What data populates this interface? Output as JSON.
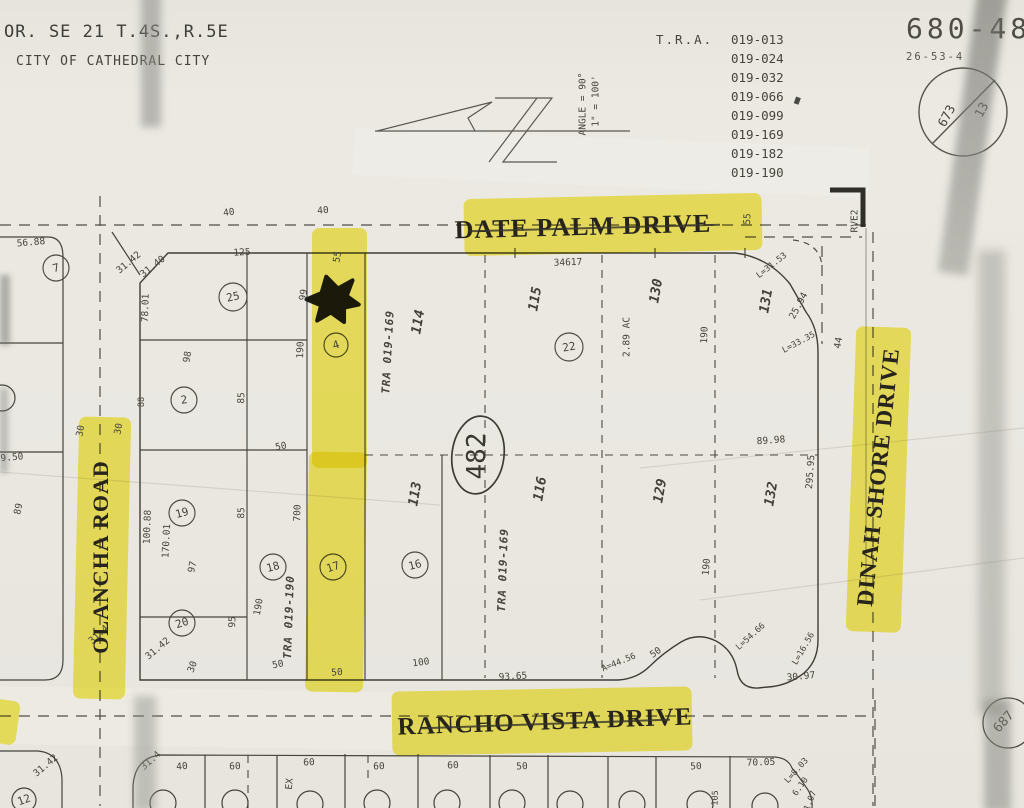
{
  "title_block": {
    "line1": "OR. SE 21 T.4S.,R.5E",
    "line2": "CITY OF CATHEDRAL CITY"
  },
  "tra_block": {
    "label": "T.R.A.",
    "codes": [
      "019-013",
      "019-024",
      "019-032",
      "019-066",
      "019-099",
      "019-169",
      "019-182",
      "019-190"
    ]
  },
  "sheet_block": {
    "number": "680-48",
    "code": "26-53-4",
    "circle_left": "673",
    "circle_right": "13",
    "adjacent_sheet": "687"
  },
  "scale_block": {
    "scale": "1\" = 100'",
    "angle": "ANGLE = 90°"
  },
  "streets": {
    "date_palm": "DATE PALM DRIVE",
    "olancha": "OLANCHA ROAD",
    "dinah_shore": "DINAH SHORE DRIVE",
    "rancho_vista": "RANCHO VISTA DRIVE",
    "right_edge_label": "RVE2"
  },
  "block_number": "482",
  "tra_zones": {
    "upper": "TRA 019-169",
    "center": "TRA 019-169",
    "lower": "TRA 019-190"
  },
  "acreage": "2.89 AC",
  "parcels": {
    "p7": "7",
    "p25": "25",
    "p2": "2",
    "p4": "4",
    "p22": "22",
    "p19": "19",
    "p18": "18",
    "p17": "17",
    "p16": "16",
    "p20": "20",
    "p12": "12"
  },
  "lots": {
    "l113": "113",
    "l114": "114",
    "l115": "115",
    "l116": "116",
    "l129": "129",
    "l130": "130",
    "l131": "131",
    "l132": "132"
  },
  "dims": {
    "top40a": "40",
    "top40b": "40",
    "d125": "125",
    "d3140": "31.40",
    "d7801": "78.01",
    "d98": "98",
    "d99": "99",
    "d190a": "190",
    "d85a": "85",
    "d88": "88",
    "d55a": "55",
    "d50a": "50",
    "d34617": "34617",
    "d55b": "55",
    "d5688": "56.88",
    "d3142a": "31.42",
    "d950": "9.50",
    "d89": "89",
    "d17001": "170.01",
    "d314a": "31.4",
    "d30a": "30",
    "d30b": "30",
    "l3153": "L=31.53",
    "d2594": "25.94",
    "l3335": "L=33.35",
    "d44": "44",
    "d190b": "190",
    "d8998": "89.98",
    "d29595": "295.95",
    "d10088": "100.88",
    "d85b": "85",
    "d700": "700",
    "d97": "97",
    "d190c": "190",
    "d95": "95",
    "d3142b": "31.42",
    "d30c": "30",
    "d50b": "50",
    "d50c": "50",
    "d100a": "100",
    "d9365": "93.65",
    "a4456": "A=44.56",
    "d50d": "50",
    "l5466": "L=54.66",
    "l1656": "L=16.56",
    "d3097": "30.97",
    "d190d": "190",
    "d3142c": "31.42",
    "d314b": "31.4",
    "d40b": "40",
    "d60a": "60",
    "d60b": "60",
    "dex": "EX",
    "d60c": "60",
    "d60d": "60",
    "d50e": "50",
    "d50f": "50",
    "d7005": "70.05",
    "l803": "L=8.03",
    "d610": "6.10",
    "d107": "1.07",
    "d105": "105"
  }
}
